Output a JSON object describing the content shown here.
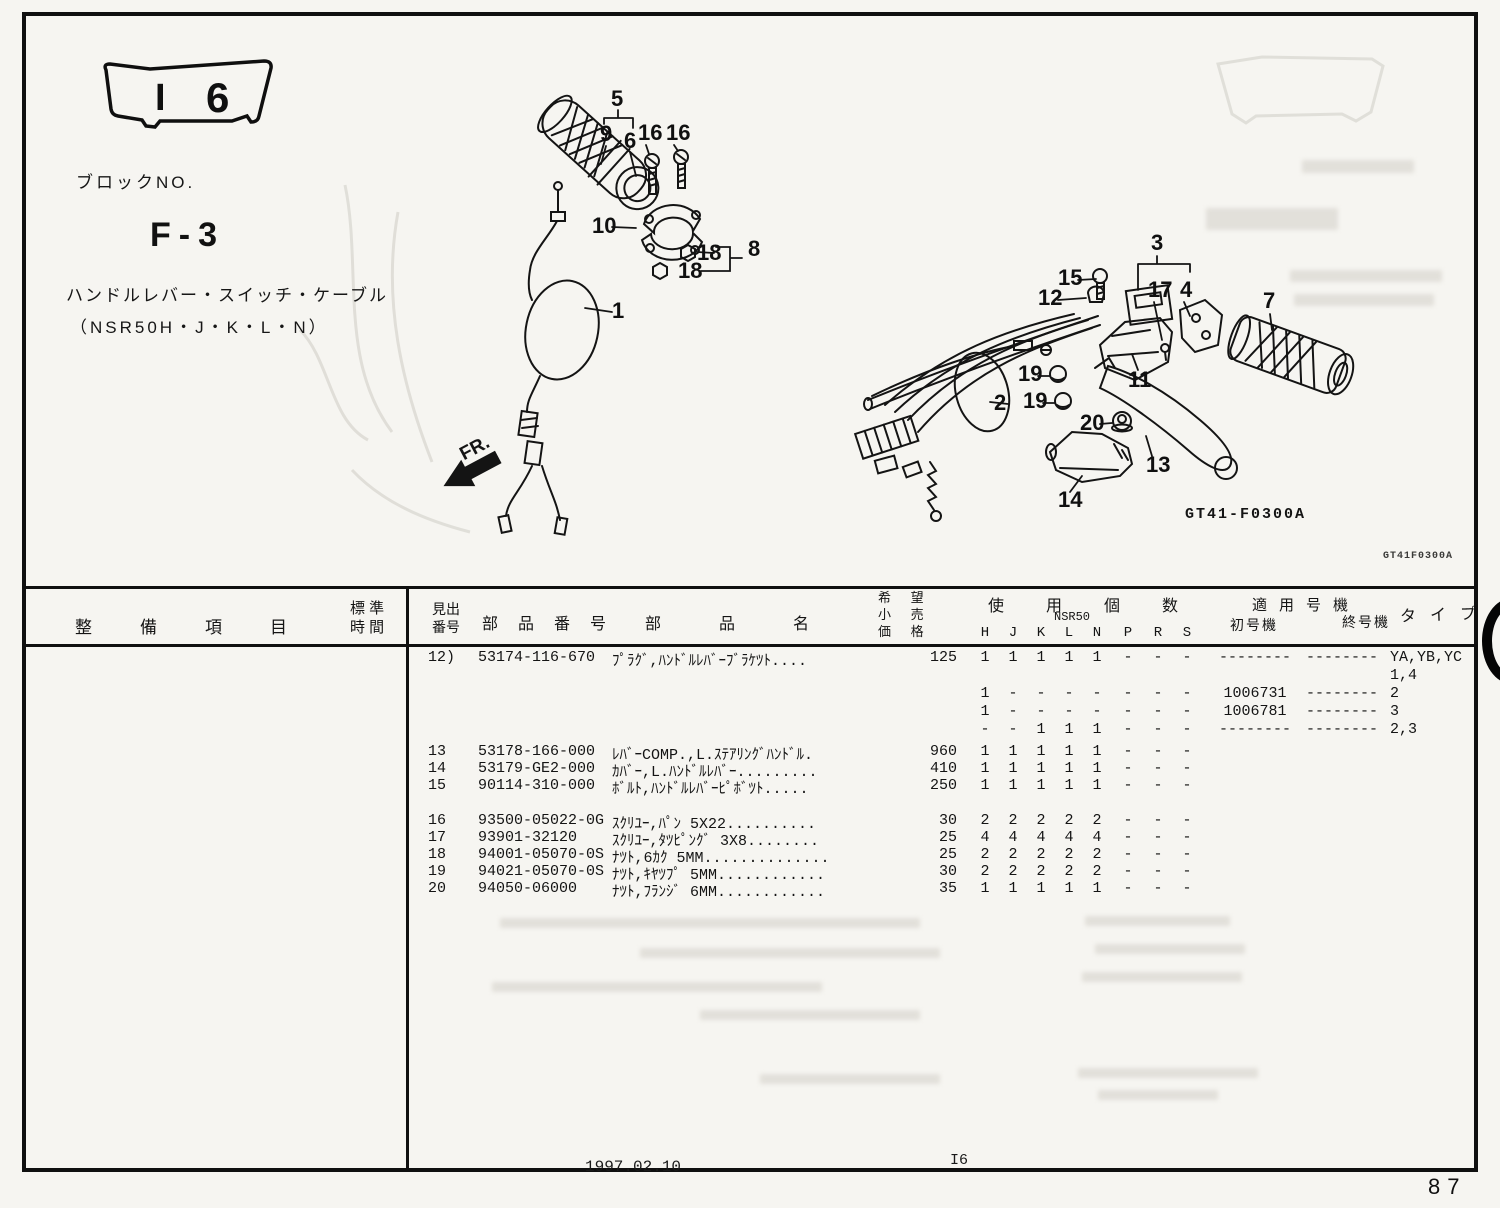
{
  "page": {
    "badge": {
      "left": "I",
      "right": "6"
    },
    "block_no_label": "ブロックNO.",
    "block_no": "F-3",
    "diagram_title": "ハンドルレバー・スイッチ・ケーブル",
    "models": "（NSR50H・J・K・L・N）",
    "fr_label": "FR.",
    "diagram_code": "GT41-F0300A",
    "edge_code": "GT41F0300A",
    "footer": {
      "date": "1997.02.10",
      "section": "I6",
      "page_number": "87"
    }
  },
  "diagram": {
    "callouts": [
      {
        "t": "5",
        "x": 611,
        "y": 106
      },
      {
        "t": "9",
        "x": 600,
        "y": 141
      },
      {
        "t": "6",
        "x": 624,
        "y": 148
      },
      {
        "t": "16",
        "x": 638,
        "y": 140
      },
      {
        "t": "16",
        "x": 666,
        "y": 140
      },
      {
        "t": "10",
        "x": 592,
        "y": 233
      },
      {
        "t": "18",
        "x": 697,
        "y": 260
      },
      {
        "t": "18",
        "x": 678,
        "y": 278
      },
      {
        "t": "8",
        "x": 748,
        "y": 256
      },
      {
        "t": "1",
        "x": 612,
        "y": 318
      },
      {
        "t": "3",
        "x": 1151,
        "y": 250
      },
      {
        "t": "15",
        "x": 1058,
        "y": 285
      },
      {
        "t": "12",
        "x": 1038,
        "y": 305
      },
      {
        "t": "17",
        "x": 1148,
        "y": 297
      },
      {
        "t": "4",
        "x": 1180,
        "y": 297
      },
      {
        "t": "7",
        "x": 1263,
        "y": 308
      },
      {
        "t": "11",
        "x": 1128,
        "y": 387
      },
      {
        "t": "2",
        "x": 994,
        "y": 410
      },
      {
        "t": "19",
        "x": 1018,
        "y": 381
      },
      {
        "t": "19",
        "x": 1023,
        "y": 408
      },
      {
        "t": "20",
        "x": 1080,
        "y": 430
      },
      {
        "t": "13",
        "x": 1146,
        "y": 472
      },
      {
        "t": "14",
        "x": 1058,
        "y": 507
      }
    ]
  },
  "table": {
    "left_header": {
      "maintenance": "整備項目",
      "standard_l1": "標 準",
      "standard_l2": "時 間"
    },
    "headers": {
      "index_l1": "見出",
      "index_l2": "番号",
      "part_number": "部品番号",
      "part_name": "部品名",
      "price_l1": "希 望",
      "price_l2": "小 売",
      "price_l3": "価 格",
      "usage": "使用個数",
      "usage_model": "NSR50",
      "usage_cols": [
        "H",
        "J",
        "K",
        "L",
        "N",
        "P",
        "R",
        "S"
      ],
      "serial": "適用号機",
      "serial_from": "初号機",
      "serial_to": "終号機",
      "type": "タイプ"
    },
    "rows": [
      {
        "group": 1,
        "idx": "12)",
        "part_no": "53174-116-670",
        "name": "ﾌﾟﾗｸﾞ,ﾊﾝﾄﾞﾙﾚﾊﾞｰﾌﾞﾗｹﾂﾄ....",
        "price": "125",
        "qty": [
          "1",
          "1",
          "1",
          "1",
          "1",
          "-",
          "-",
          "-"
        ],
        "from": "--------",
        "to": "--------",
        "type": "YA,YB,YC"
      },
      {
        "group": 1,
        "type": "1,4"
      },
      {
        "group": 1,
        "qty": [
          "1",
          "-",
          "-",
          "-",
          "-",
          "-",
          "-",
          "-"
        ],
        "from": "1006731",
        "to": "--------",
        "type": "2"
      },
      {
        "group": 1,
        "qty": [
          "1",
          "-",
          "-",
          "-",
          "-",
          "-",
          "-",
          "-"
        ],
        "from": "1006781",
        "to": "--------",
        "type": "3"
      },
      {
        "group": 1,
        "qty": [
          "-",
          "-",
          "1",
          "1",
          "1",
          "-",
          "-",
          "-"
        ],
        "from": "--------",
        "to": "--------",
        "type": "2,3"
      },
      {
        "group": 2,
        "idx": "13",
        "part_no": "53178-166-000",
        "name": "ﾚﾊﾞｰCOMP.,L.ｽﾃｱﾘﾝｸﾞﾊﾝﾄﾞﾙ.",
        "price": "960",
        "qty": [
          "1",
          "1",
          "1",
          "1",
          "1",
          "-",
          "-",
          "-"
        ]
      },
      {
        "group": 2,
        "idx": "14",
        "part_no": "53179-GE2-000",
        "name": "ｶﾊﾞｰ,L.ﾊﾝﾄﾞﾙﾚﾊﾞｰ.........",
        "price": "410",
        "qty": [
          "1",
          "1",
          "1",
          "1",
          "1",
          "-",
          "-",
          "-"
        ]
      },
      {
        "group": 2,
        "idx": "15",
        "part_no": "90114-310-000",
        "name": "ﾎﾞﾙﾄ,ﾊﾝﾄﾞﾙﾚﾊﾞｰﾋﾟﾎﾞﾂﾄ.....",
        "price": "250",
        "qty": [
          "1",
          "1",
          "1",
          "1",
          "1",
          "-",
          "-",
          "-"
        ]
      },
      {
        "group": 3,
        "idx": "16",
        "part_no": "93500-05022-0G",
        "name": "ｽｸﾘﾕｰ,ﾊﾟﾝ 5X22..........",
        "price": "30",
        "qty": [
          "2",
          "2",
          "2",
          "2",
          "2",
          "-",
          "-",
          "-"
        ]
      },
      {
        "group": 3,
        "idx": "17",
        "part_no": "93901-32120",
        "name": "ｽｸﾘﾕｰ,ﾀﾂﾋﾟﾝｸﾞ 3X8........",
        "price": "25",
        "qty": [
          "4",
          "4",
          "4",
          "4",
          "4",
          "-",
          "-",
          "-"
        ]
      },
      {
        "group": 3,
        "idx": "18",
        "part_no": "94001-05070-0S",
        "name": "ﾅﾂﾄ,6ｶｸ 5MM..............",
        "price": "25",
        "qty": [
          "2",
          "2",
          "2",
          "2",
          "2",
          "-",
          "-",
          "-"
        ]
      },
      {
        "group": 3,
        "idx": "19",
        "part_no": "94021-05070-0S",
        "name": "ﾅﾂﾄ,ｷﾔﾂﾌﾟ 5MM............",
        "price": "30",
        "qty": [
          "2",
          "2",
          "2",
          "2",
          "2",
          "-",
          "-",
          "-"
        ]
      },
      {
        "group": 3,
        "idx": "20",
        "part_no": "94050-06000",
        "name": "ﾅﾂﾄ,ﾌﾗﾝｼﾞ 6MM............",
        "price": "35",
        "qty": [
          "1",
          "1",
          "1",
          "1",
          "1",
          "-",
          "-",
          "-"
        ]
      }
    ]
  }
}
